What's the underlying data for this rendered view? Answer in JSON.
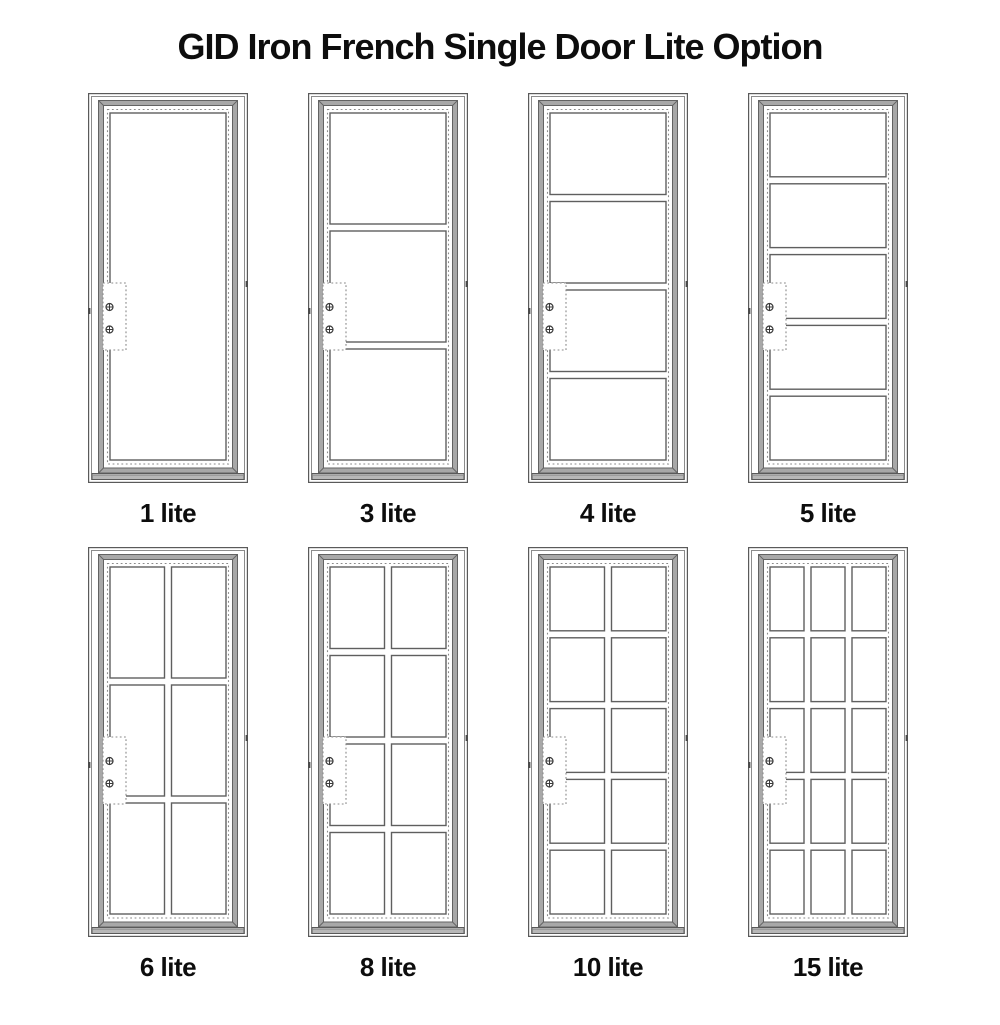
{
  "page": {
    "title": "GID Iron French Single Door Lite Option"
  },
  "colors": {
    "background": "#ffffff",
    "text": "#0d0d0d",
    "frame_line": "#5a5a5a",
    "frame_line_light": "#8c8c8c",
    "slab_fill": "#a8a8a8",
    "slab_edge": "#636363",
    "dash_line": "#8a8a8a",
    "glass_line": "#5f5f5f",
    "threshold_fill": "#b8b8b8",
    "screw_line": "#3a3a3a",
    "hinge_tick": "#4a4a4a"
  },
  "icons": {
    "screw": "screw-crosshair-icon"
  },
  "doors": [
    {
      "label": "1 lite",
      "cols": 1,
      "rows": 1
    },
    {
      "label": "3 lite",
      "cols": 1,
      "rows": 3
    },
    {
      "label": "4 lite",
      "cols": 1,
      "rows": 4
    },
    {
      "label": "5 lite",
      "cols": 1,
      "rows": 5
    },
    {
      "label": "6 lite",
      "cols": 2,
      "rows": 3
    },
    {
      "label": "8 lite",
      "cols": 2,
      "rows": 4
    },
    {
      "label": "10 lite",
      "cols": 2,
      "rows": 5
    },
    {
      "label": "15 lite",
      "cols": 3,
      "rows": 5
    }
  ]
}
